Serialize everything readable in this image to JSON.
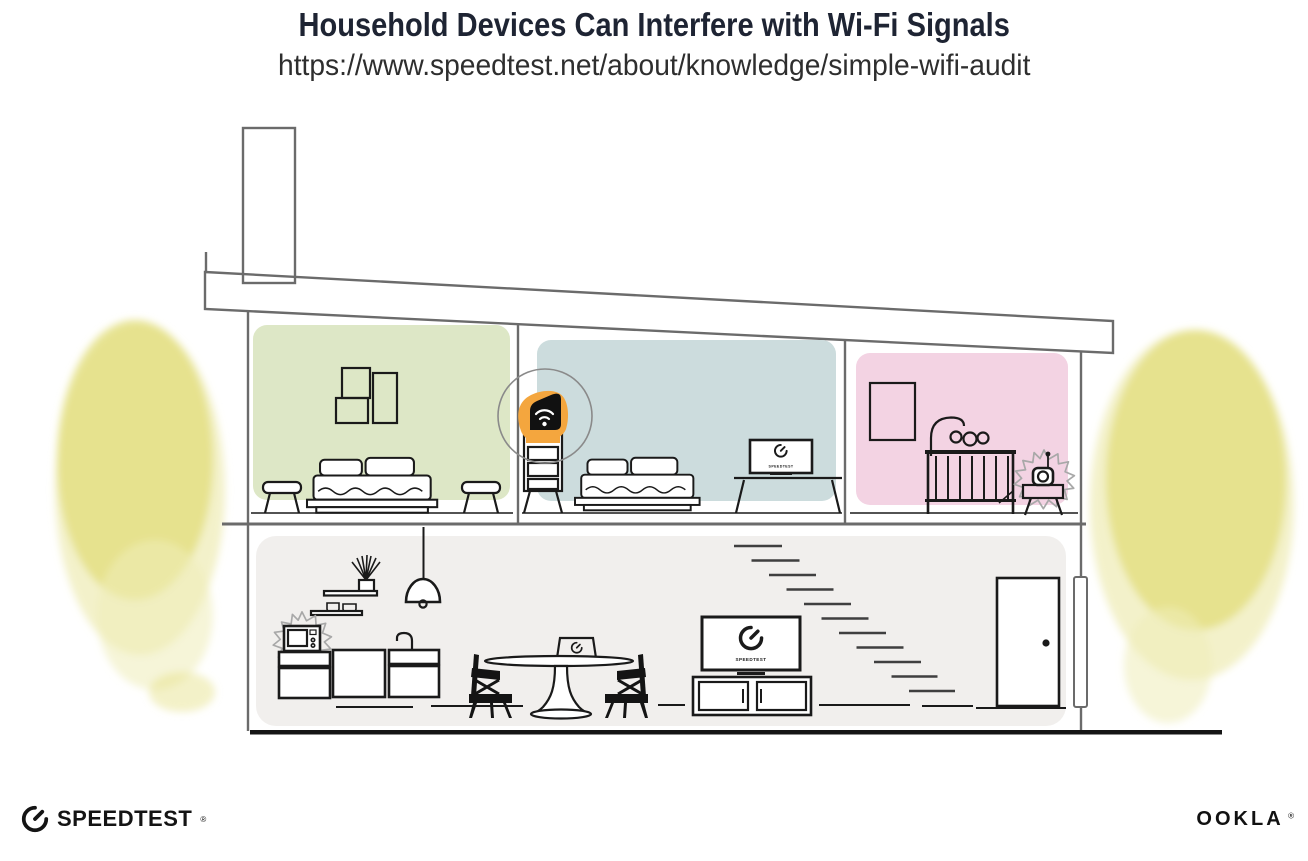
{
  "header": {
    "title": "Household Devices Can Interfere with Wi-Fi Signals",
    "url": "https://www.speedtest.net/about/knowledge/simple-wifi-audit"
  },
  "branding": {
    "speedtest_wordmark": "SPEEDTEST",
    "speedtest_reg": "®",
    "speedtest_icon": "speedtest-gauge-icon",
    "ookla_wordmark": "OOKLA",
    "ookla_reg": "®"
  },
  "devices": {
    "router": {
      "icon": "wifi-icon"
    },
    "bedroom_tv": {
      "screen_label": "SPEEDTEST",
      "icon": "speedtest-gauge-icon"
    },
    "living_room_tv": {
      "screen_label": "SPEEDTEST",
      "icon": "speedtest-gauge-icon"
    },
    "dining_laptop": {
      "icon": "speedtest-gauge-icon"
    },
    "microwave": {
      "icon": "microwave-icon"
    },
    "baby_monitor": {
      "icon": "baby-monitor-icon"
    }
  },
  "colors": {
    "accent_orange": "#F4A63E",
    "bedroom_green": "#DDE7C6",
    "bedroom_blue": "#CCDCDD",
    "nursery_pink": "#F3D3E3",
    "lower_floor_gray": "#F1EFED",
    "foliage_yellow": "#E4E084",
    "foliage_yellow_light": "#EFECB8",
    "line_gray": "#6B6B6B",
    "ink": "#1A1A1A",
    "title_navy": "#1E2433"
  }
}
